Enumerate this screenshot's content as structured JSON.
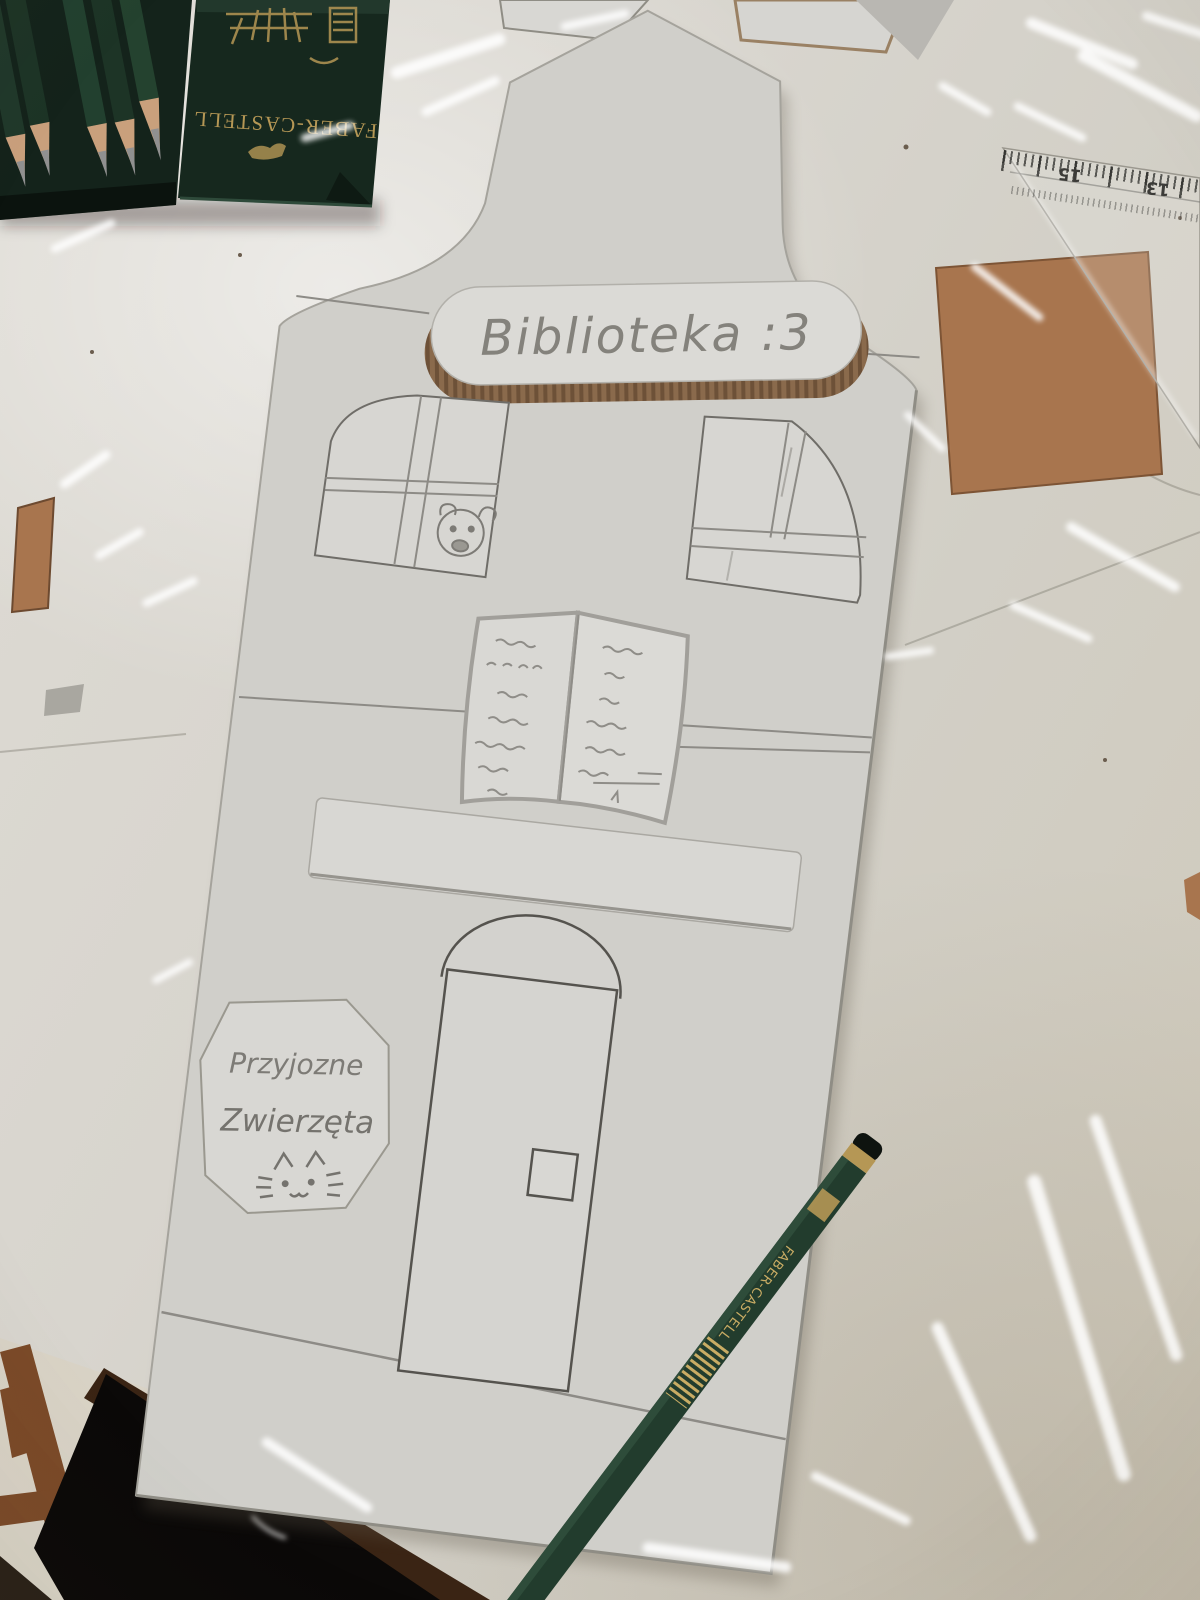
{
  "scene": {
    "building_sign": {
      "text": "Biblioteka :3"
    },
    "door_sign": {
      "line1": "Przyjozne",
      "line2": "Zwierzęta"
    },
    "pencil_tin": {
      "brand": "FABER-CASTELL"
    },
    "pencil": {
      "brand": "FABER-CASTELL"
    },
    "ruler": {
      "mark_left": "15",
      "mark_right": "13"
    }
  },
  "colors": {
    "table": "#dedbd4",
    "table_dark": "#cfc9ba",
    "building": "#d0cfca",
    "cardboard_white": "#dbdad6",
    "cardboard_brown": "#a8754e",
    "corrugate": "#8a6a4c",
    "pencil_line": "#8d8b86",
    "tin_green": "#16281e",
    "pencil_green": "#223c2d",
    "gold": "#b59755",
    "wood": "#c9a07c",
    "graphite": "#909090",
    "table_edge": "#3a2414",
    "chair_wood": "#7b4a28"
  }
}
